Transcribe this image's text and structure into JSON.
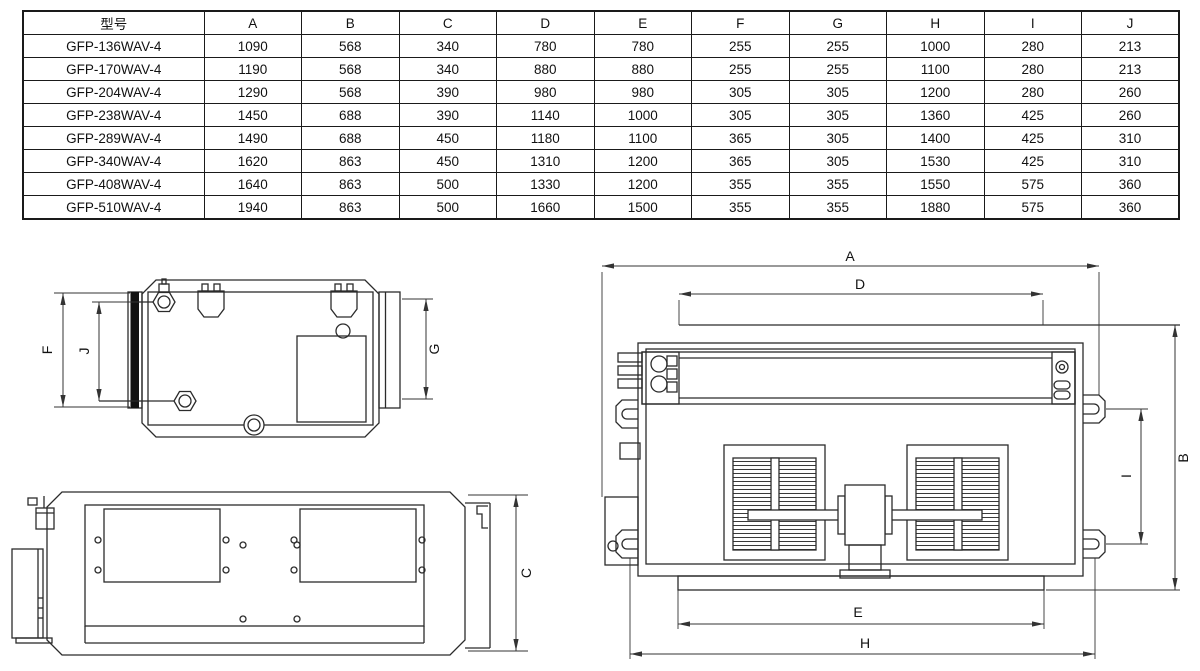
{
  "table": {
    "headers": [
      "型号",
      "A",
      "B",
      "C",
      "D",
      "E",
      "F",
      "G",
      "H",
      "I",
      "J"
    ],
    "rows": [
      [
        "GFP-136WAV-4",
        "1090",
        "568",
        "340",
        "780",
        "780",
        "255",
        "255",
        "1000",
        "280",
        "213"
      ],
      [
        "GFP-170WAV-4",
        "1190",
        "568",
        "340",
        "880",
        "880",
        "255",
        "255",
        "1100",
        "280",
        "213"
      ],
      [
        "GFP-204WAV-4",
        "1290",
        "568",
        "390",
        "980",
        "980",
        "305",
        "305",
        "1200",
        "280",
        "260"
      ],
      [
        "GFP-238WAV-4",
        "1450",
        "688",
        "390",
        "1140",
        "1000",
        "305",
        "305",
        "1360",
        "425",
        "260"
      ],
      [
        "GFP-289WAV-4",
        "1490",
        "688",
        "450",
        "1180",
        "1100",
        "365",
        "305",
        "1400",
        "425",
        "310"
      ],
      [
        "GFP-340WAV-4",
        "1620",
        "863",
        "450",
        "1310",
        "1200",
        "365",
        "305",
        "1530",
        "425",
        "310"
      ],
      [
        "GFP-408WAV-4",
        "1640",
        "863",
        "500",
        "1330",
        "1200",
        "355",
        "355",
        "1550",
        "575",
        "360"
      ],
      [
        "GFP-510WAV-4",
        "1940",
        "863",
        "500",
        "1660",
        "1500",
        "355",
        "355",
        "1880",
        "575",
        "360"
      ]
    ]
  },
  "drawings": {
    "side_view": {
      "dim_f": "F",
      "dim_j": "J",
      "dim_g": "G"
    },
    "front_view": {
      "dim_c": "C"
    },
    "top_view": {
      "dim_a": "A",
      "dim_d": "D",
      "dim_b": "B",
      "dim_i": "I",
      "dim_e": "E",
      "dim_h": "H"
    }
  },
  "colors": {
    "background": "#ffffff",
    "line": "#2b2b2b",
    "text": "#111111"
  }
}
